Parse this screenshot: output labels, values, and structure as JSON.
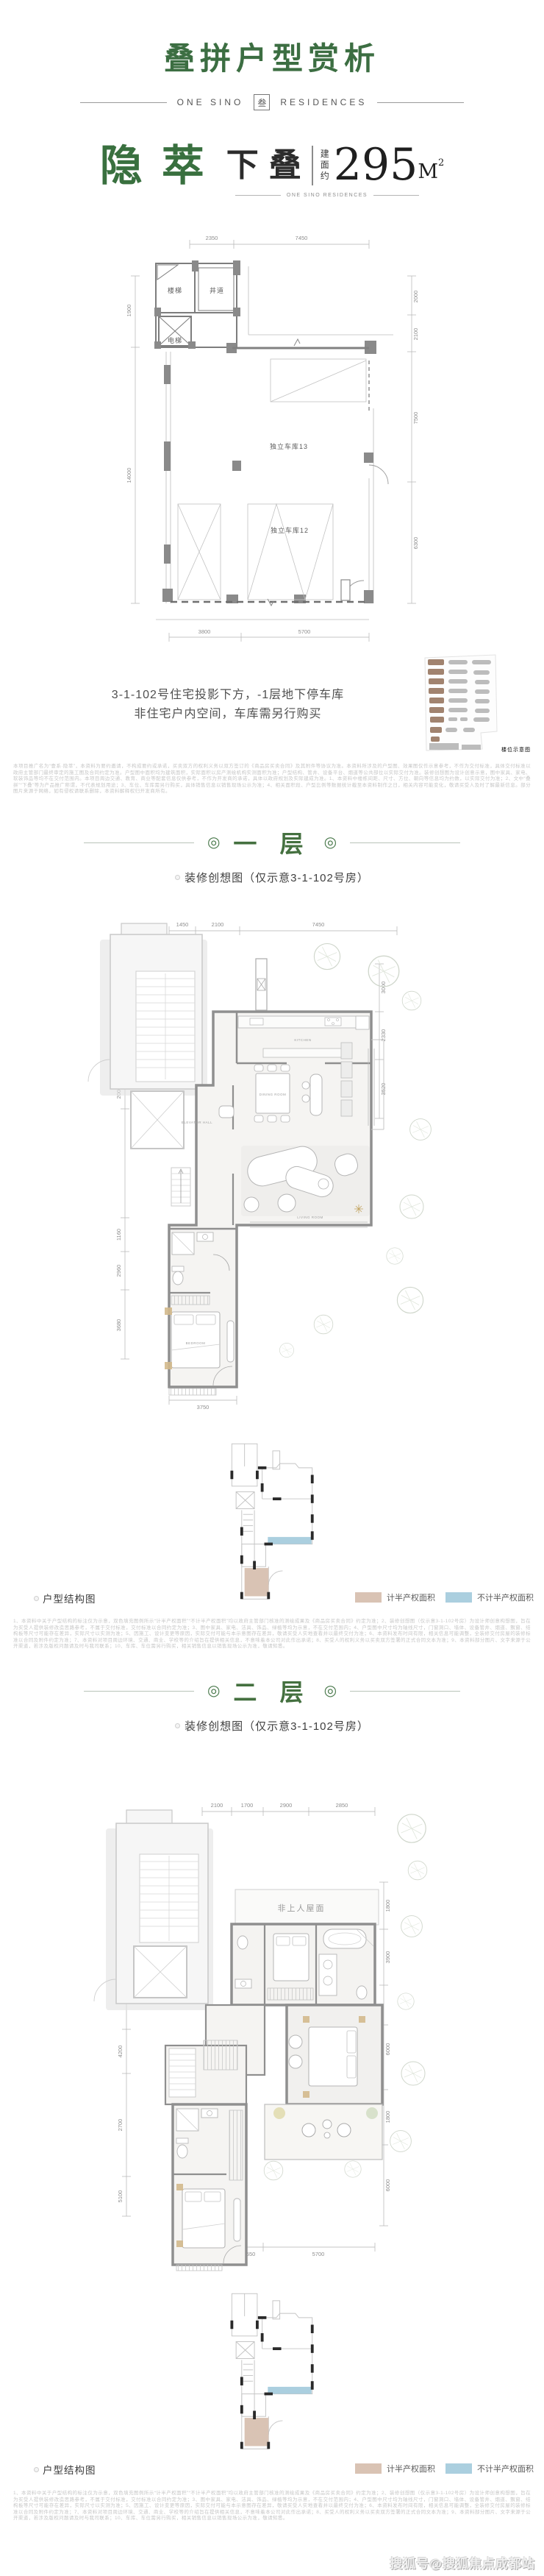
{
  "header": {
    "title": "叠拼户型赏析",
    "brand_left": "ONE SINO",
    "brand_logo": "叁",
    "brand_right": "RESIDENCES"
  },
  "deco": "◎",
  "unit": {
    "name_left": "隐",
    "name_right": "萃",
    "type_label": "下叠",
    "area_prefix": [
      "建",
      "面",
      "约"
    ],
    "area_value": "295",
    "area_unit": "M",
    "area_sup": "2",
    "sub_brand": "ONE SINO RESIDENCES"
  },
  "basement": {
    "dims": {
      "top": [
        "2350",
        "7450"
      ],
      "left": [
        "1900",
        "14000"
      ],
      "right": [
        "2000",
        "2100",
        "7500",
        "6300"
      ],
      "bottom": [
        "3800",
        "5700"
      ]
    },
    "rooms": {
      "stair": "楼梯",
      "shaft": "井道",
      "elevator": "电梯",
      "garage13": "独立车库13",
      "garage12": "独立车库12"
    },
    "note1": "3-1-102号住宅投影下方，-1层地下停车库",
    "note2": "非住宅户内空间，车库需另行购买",
    "site_caption": "楼位示意图"
  },
  "disclaimer_top": "本项目推广名为“壹系·隐萃”，本资料为要约邀请，不构成要约或承诺，买卖双方的权利义务以双方签订的《商品房买卖合同》及其附件等协议为准。本资料所涉及的户型图、效果图仅作示意参考，不作为交付标准，具体交付标准以政府主管部门最终审定的施工图及合同约定为准。户型图中面积均为建筑面积，实际面积以房产测绘机构实测面积为准；户型结构、管井、设备平台、烟道等公共部位以实际交付为准。装修创想图为设计创意示意，图中家具、家电、软装饰品等均不在交付范围内。本项目周边交通、教育、商业等配套信息仅供参考，不作为开发商的承诺，具体以政府规划及实际建成为准。1、本资料中楼栋间距、尺寸、方位、朝向等信息均为约数，以实际交付为准；2、文中“叠拼”“下叠”等为产品推广称谓，不代表规划用途；3、车位、车库需另行购买，具体销售信息以销售现场公示为准；4、相关面积段、户型比例等数据统计截至本资料制作之日，相关内容可能变化，敬请买受人及时了解最新信息。部分图片来源于网络，如有侵权请联系删除，本资料解释权归开发商所有。",
  "floor1": {
    "title": "一 层",
    "caption": "装修创想图（仅示意3-1-102号房）",
    "dims": {
      "top": [
        "1450",
        "2100",
        "7450"
      ],
      "left": [
        "3000",
        "1400",
        "2000",
        "2000",
        "1160",
        "2960",
        "3680"
      ],
      "right": [
        "3000",
        "2330",
        "3520"
      ],
      "bottom": [
        "3750"
      ]
    },
    "labels": {
      "kitchen": "KITCHEN",
      "dining": "DINING ROOM",
      "living": "LIVING ROOM",
      "hall": "ELEVATOR HALL",
      "bedroom": "BEDROOM"
    }
  },
  "floor2": {
    "title": "二 层",
    "caption": "装修创想图（仅示意3-1-102号房）",
    "roof": "非上人屋面",
    "dims": {
      "top": [
        "2100",
        "1700",
        "2900",
        "2850"
      ],
      "left": [
        "2000",
        "2000",
        "1900",
        "4200",
        "2700",
        "5100"
      ],
      "right": [
        "1800",
        "3900",
        "6000",
        "1800",
        "6000"
      ],
      "bottom": [
        "3750",
        "1550",
        "5700"
      ]
    }
  },
  "structure": {
    "label": "户型结构图",
    "legend_half": "计半产权面积",
    "legend_nohalf": "不计半产权面积",
    "half_color": "#d9c3b4",
    "nohalf_color": "#abcfdf"
  },
  "disclaimer_floor": "1、本资料中关于户型结构的标注仅为示意，双色填充图例所示“计半产权面积”“不计半产权面积”均以政府主管部门核准的测绘成果及《商品房买卖合同》约定为准；2、装修创想图（仅示意3-1-102号房）为设计师创意构想图，旨在为买受人提供装修改造思路参考，不属于交付标准，交付标准以合同约定为准；3、图中家具、家电、洁具、饰品、绿植等均为示意，不在交付范围内；4、户型图中尺寸均为轴线尺寸，门窗洞口、墙体、设备管井、烟道、飘窗、结构板等尺寸可能存在差异，实际尺寸以实测为准；5、因施工、设计变更等原因，实际交付可能与本示意图存在差异，敬请买受人实地查看并以最终交付为准；6、本资料发布时间有限，相关信息可能调整，全装修交付房屋的装修标准以合同及附件约定为准；7、本资料对项目周边环境、交通、商业、学校等的介绍旨在提供相关信息，不意味着本公司对此作出承诺；8、买受人的权利义务以买卖双方签署的正式合同文本为准；9、本资料部分图片、文字来源于公开渠道，若涉及版权问题请及时与我司联系；10、车库、车位需另行购买，相关销售信息以销售现场公示为准，敬请知悉。",
  "watermark": "搜狐号@搜狐焦点成都站"
}
